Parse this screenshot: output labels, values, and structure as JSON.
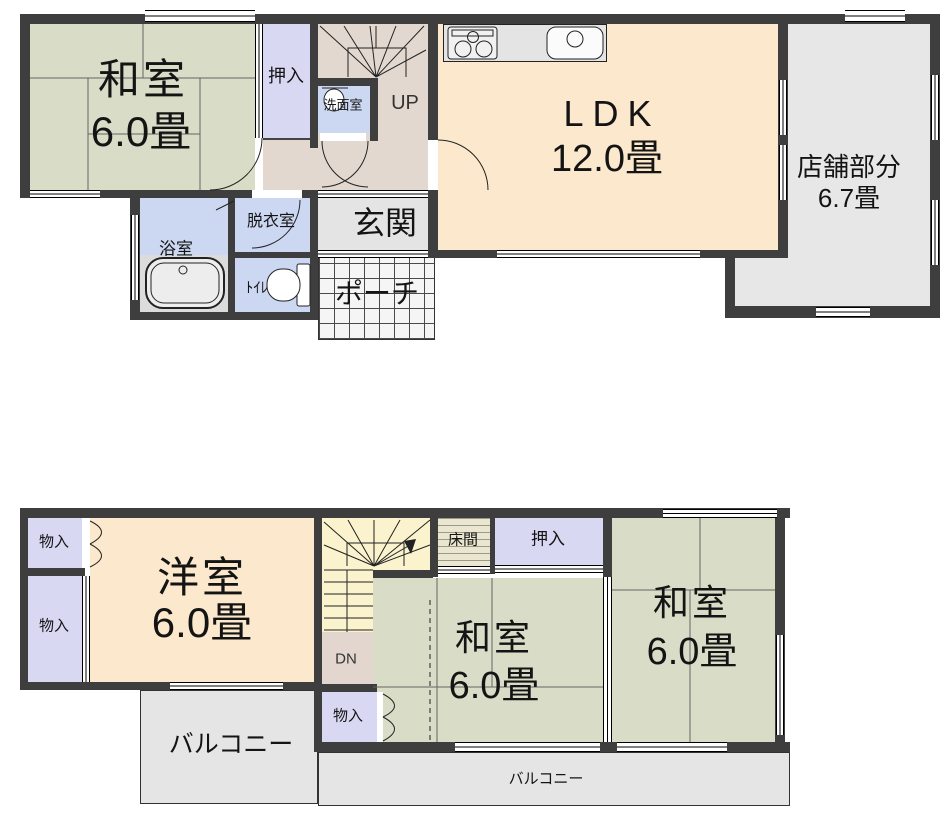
{
  "floor1": {
    "rooms": {
      "washitsu": {
        "name": "和室",
        "size": "6.0畳"
      },
      "oshiire": {
        "label": "押入"
      },
      "senmenshitsu": {
        "label": "洗面室"
      },
      "stairs": {
        "label": "UP"
      },
      "ldk": {
        "name": "LDK",
        "size": "12.0畳"
      },
      "tenpo": {
        "name": "店舗部分",
        "size": "6.7畳"
      },
      "yokushitsu": {
        "label": "浴室"
      },
      "datsuishitsu": {
        "label": "脱衣室"
      },
      "toilet": {
        "label": "ﾄｲﾚ"
      },
      "genkan": {
        "label": "玄関"
      },
      "porch": {
        "label": "ポーチ"
      }
    }
  },
  "floor2": {
    "rooms": {
      "monoire_top": {
        "label": "物入"
      },
      "monoire_left": {
        "label": "物入"
      },
      "monoire_lower": {
        "label": "物入"
      },
      "yoshitsu": {
        "name": "洋室",
        "size": "6.0畳"
      },
      "stairs": {
        "label": "DN"
      },
      "tokonoma": {
        "label": "床間"
      },
      "oshiire": {
        "label": "押入"
      },
      "washitsu_center": {
        "name": "和室",
        "size": "6.0畳"
      },
      "washitsu_right": {
        "name": "和室",
        "size": "6.0畳"
      },
      "balcony_left": {
        "label": "バルコニー"
      },
      "balcony_bottom": {
        "label": "バルコニー"
      }
    }
  },
  "colors": {
    "wall": "#3e3e3e",
    "tatami_green": "#d9dcc7",
    "closet_lavender": "#d9d8f3",
    "room_cream": "#fbe8cd",
    "hall_beige": "#e2d8d0",
    "wet_blue": "#ccd8f2",
    "gray_room": "#e7e7e7",
    "stair_yellow": "#faf3cd",
    "balcony_gray": "#e5e5e5"
  }
}
